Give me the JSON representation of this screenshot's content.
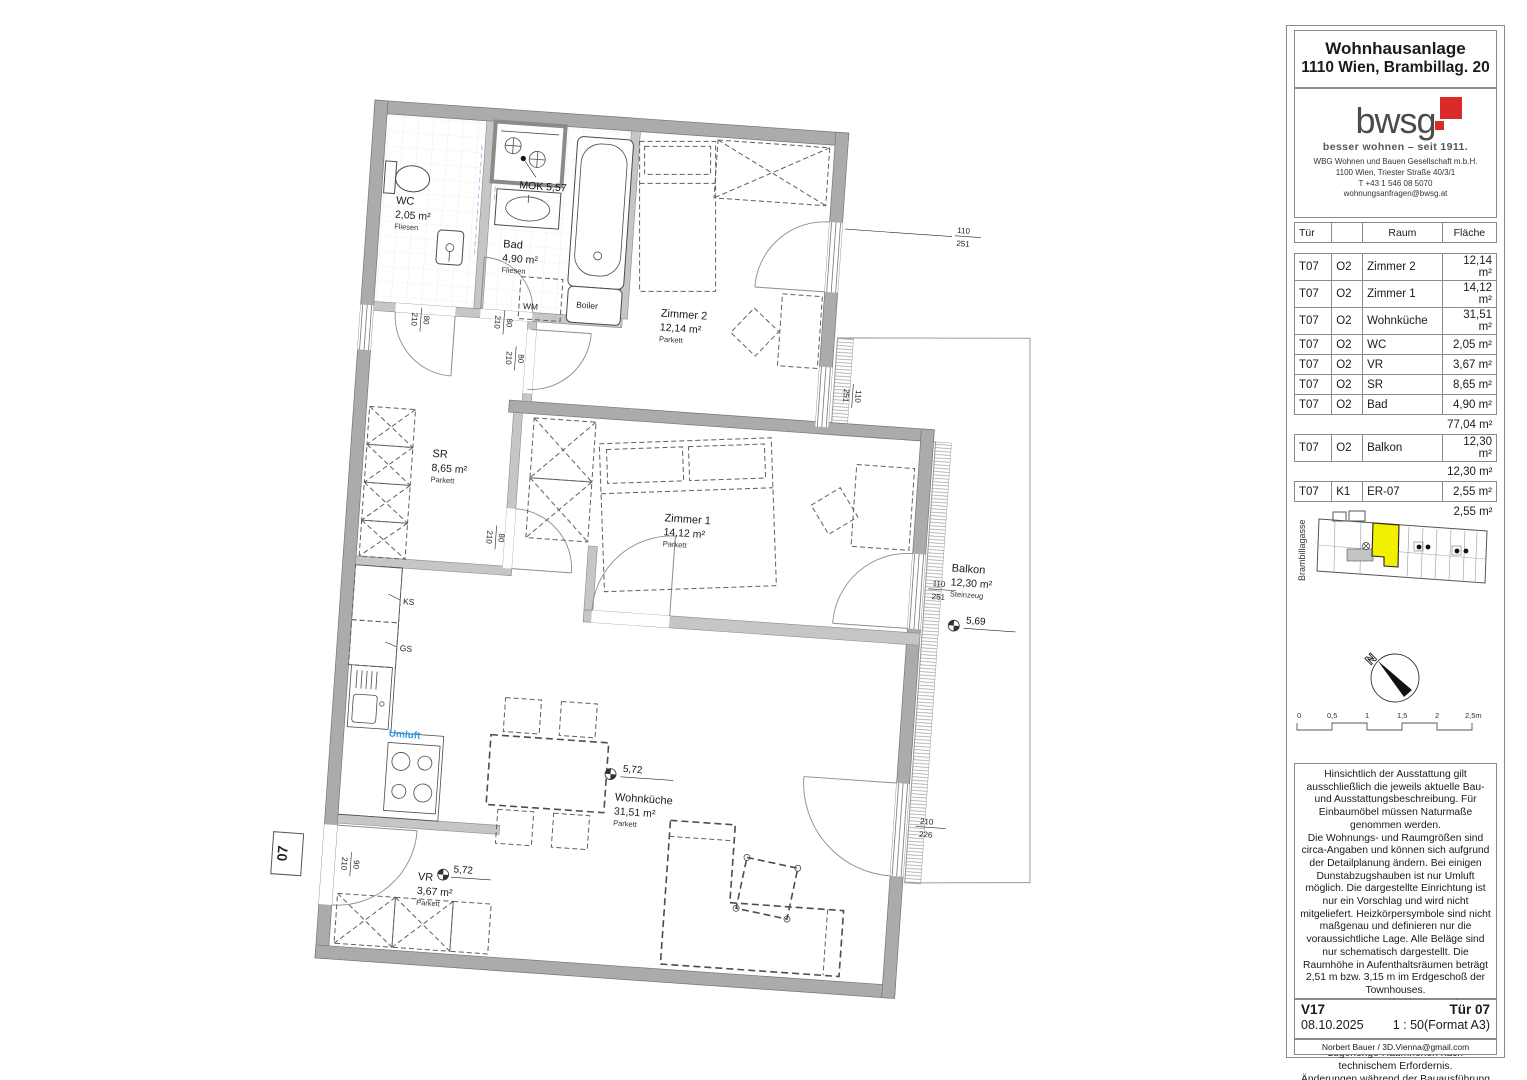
{
  "panel": {
    "title_line1": "Wohnhausanlage",
    "title_line2": "1110 Wien, Brambillag. 20",
    "logo": {
      "wordmark": "bwsg",
      "tagline": "besser wohnen – seit 1911.",
      "company_lines": "WBG Wohnen und Bauen Gesellschaft m.b.H.\n1100 Wien, Triester Straße 40/3/1\nT +43 1 546 08 5070\nwohnungsanfragen@bwsg.at",
      "red": "#da2a2a"
    },
    "table": {
      "headers": {
        "tuer": "Tür",
        "raum": "Raum",
        "flaeche": "Fläche"
      },
      "rows": [
        {
          "tuer": "T07",
          "ebene": "O2",
          "raum": "Zimmer 2",
          "flaeche": "12,14 m²"
        },
        {
          "tuer": "T07",
          "ebene": "O2",
          "raum": "Zimmer 1",
          "flaeche": "14,12 m²"
        },
        {
          "tuer": "T07",
          "ebene": "O2",
          "raum": "Wohnküche",
          "flaeche": "31,51 m²"
        },
        {
          "tuer": "T07",
          "ebene": "O2",
          "raum": "WC",
          "flaeche": "2,05 m²"
        },
        {
          "tuer": "T07",
          "ebene": "O2",
          "raum": "VR",
          "flaeche": "3,67 m²"
        },
        {
          "tuer": "T07",
          "ebene": "O2",
          "raum": "SR",
          "flaeche": "8,65 m²"
        },
        {
          "tuer": "T07",
          "ebene": "O2",
          "raum": "Bad",
          "flaeche": "4,90 m²"
        },
        {
          "tuer": "",
          "ebene": "",
          "raum": "",
          "flaeche": "77,04 m²"
        },
        {
          "tuer": "T07",
          "ebene": "O2",
          "raum": "Balkon",
          "flaeche": "12,30 m²"
        },
        {
          "tuer": "",
          "ebene": "",
          "raum": "",
          "flaeche": "12,30 m²"
        },
        {
          "tuer": "T07",
          "ebene": "K1",
          "raum": "ER-07",
          "flaeche": "2,55 m²"
        },
        {
          "tuer": "",
          "ebene": "",
          "raum": "",
          "flaeche": "2,55 m²"
        }
      ]
    },
    "siteplan": {
      "street": "Brambillagasse",
      "highlight": "#f2ef00"
    },
    "north_label": "N",
    "scalebar": {
      "l0": "0",
      "l1": "0,5",
      "l2": "1",
      "l3": "1,5",
      "l4": "2",
      "l5": "2,5m"
    },
    "disclaimer": "Hinsichtlich der Ausstattung gilt ausschließlich die jeweils aktuelle Bau- und Ausstattungsbeschreibung. Für Einbaumöbel müssen Naturmaße genommen werden.\nDie Wohnungs- und Raumgrößen sind circa-Angaben und können sich aufgrund der Detailplanung ändern. Bei einigen Dunstabzugshauben ist nur Umluft möglich. Die dargestellte Einrichtung ist nur ein Vorschlag und wird nicht mitgeliefert. Heizkörpersymbole sind nicht maßgenau und definieren nur die voraussichtliche Lage. Alle Beläge sind nur schematisch dargestellt. Die Raumhöhe in Aufenthaltsräumen beträgt 2,51 m bzw. 3,15 m im Erdgeschoß der Townhouses.\nIn Top 17-20 sind im 1. Stock, bauordnungsbestimmend, Vorkehrungen für den Einbau einer Küche geplant.\nAbgehängte Decken, Potterien und zugehörige Raumhöhen nach technischem Erfordernis.\nÄnderungen während der Bauausführung vorbehalten.",
    "footer": {
      "version": "V17",
      "door": "Tür 07",
      "date": "08.10.2025",
      "scale": "1 : 50(Format A3)",
      "author": "Norbert Bauer / 3D.Vienna@gmail.com"
    }
  },
  "plan": {
    "rooms": {
      "wc": {
        "name": "WC",
        "area": "2,05 m²",
        "floor": "Fliesen"
      },
      "bad": {
        "name": "Bad",
        "area": "4,90 m²",
        "floor": "Fliesen"
      },
      "zimmer2": {
        "name": "Zimmer 2",
        "area": "12,14 m²",
        "floor": "Parkett"
      },
      "sr": {
        "name": "SR",
        "area": "8,65 m²",
        "floor": "Parkett"
      },
      "zimmer1": {
        "name": "Zimmer 1",
        "area": "14,12 m²",
        "floor": "Parkett"
      },
      "wohnkueche": {
        "name": "Wohnküche",
        "area": "31,51 m²",
        "floor": "Parkett"
      },
      "vr": {
        "name": "VR",
        "area": "3,67 m²",
        "floor": "Parkett"
      },
      "balkon": {
        "name": "Balkon",
        "area": "12,30 m²",
        "floor": "Steinzeug"
      }
    },
    "labels": {
      "mok": "MOK 5,57",
      "boiler": "Boiler",
      "wm": "WM",
      "ks": "KS",
      "gs": "GS",
      "umluft": "Umluft",
      "entry": "07"
    },
    "levels": {
      "wohnkueche": "5,72",
      "vr": "5,72",
      "balkon": "5,69"
    },
    "umluft_color": "#2e9be6",
    "dims": {
      "wc_door": {
        "w": "80",
        "h": "210"
      },
      "bad_door": {
        "w": "80",
        "h": "210"
      },
      "zimmer2_door": {
        "w": "80",
        "h": "210"
      },
      "sr_door": {
        "w": "80",
        "h": "210"
      },
      "entry_door": {
        "w": "90",
        "h": "210"
      },
      "z2_window1": {
        "w": "110",
        "h": "251"
      },
      "z2_window2": {
        "w": "110",
        "h": "251"
      },
      "z1_door": {
        "w": "110",
        "h": "251"
      },
      "wk_door": {
        "w": "210",
        "h": "226"
      }
    }
  }
}
